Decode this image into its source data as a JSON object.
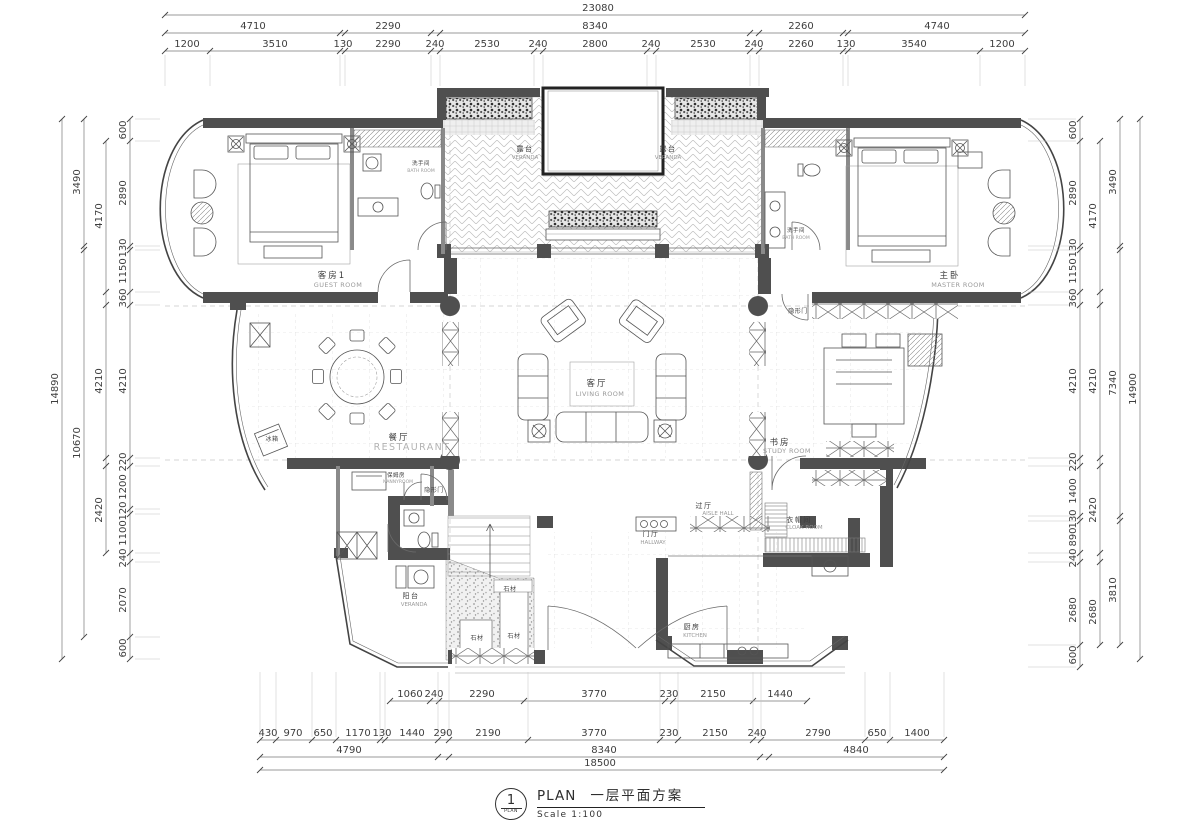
{
  "title": {
    "sheet_no": "1",
    "circle_sub": "PLAN",
    "plan_label": "PLAN",
    "cn_title": "一层平面方案",
    "scale_label": "Scale 1:100"
  },
  "dimensions": [
    {
      "axis": "x",
      "pos": 15,
      "span": [
        165,
        1025
      ],
      "ticks": [
        165,
        1025
      ],
      "labels": [
        {
          "t": "23080",
          "p": 598
        }
      ]
    },
    {
      "axis": "x",
      "pos": 33,
      "span": [
        165,
        1025
      ],
      "ticks": [
        165,
        340,
        345,
        431,
        440,
        750,
        759,
        843,
        848,
        1025
      ],
      "labels": [
        {
          "t": "4710",
          "p": 253
        },
        {
          "t": "2290",
          "p": 388
        },
        {
          "t": "8340",
          "p": 595
        },
        {
          "t": "2260",
          "p": 801
        },
        {
          "t": "4740",
          "p": 937
        }
      ]
    },
    {
      "axis": "x",
      "pos": 51,
      "span": [
        165,
        1025
      ],
      "ticks": [
        165,
        210,
        340,
        345,
        431,
        440,
        534,
        543,
        647,
        656,
        750,
        759,
        843,
        848,
        980,
        1025
      ],
      "ext": [
        55,
        86
      ],
      "labels": [
        {
          "t": "1200",
          "p": 187
        },
        {
          "t": "3510",
          "p": 275
        },
        {
          "t": "130",
          "p": 343
        },
        {
          "t": "2290",
          "p": 388
        },
        {
          "t": "240",
          "p": 435
        },
        {
          "t": "2530",
          "p": 487
        },
        {
          "t": "240",
          "p": 538
        },
        {
          "t": "2800",
          "p": 595
        },
        {
          "t": "240",
          "p": 651
        },
        {
          "t": "2530",
          "p": 703
        },
        {
          "t": "240",
          "p": 754
        },
        {
          "t": "2260",
          "p": 801
        },
        {
          "t": "130",
          "p": 846
        },
        {
          "t": "3540",
          "p": 914
        },
        {
          "t": "1200",
          "p": 1002
        }
      ]
    },
    {
      "axis": "x",
      "pos": 701,
      "span": [
        390,
        807
      ],
      "ticks": [
        390,
        430,
        439,
        524,
        665,
        673,
        753,
        807
      ],
      "labels": [
        {
          "t": "1060",
          "p": 410
        },
        {
          "t": "240",
          "p": 434
        },
        {
          "t": "2290",
          "p": 482
        },
        {
          "t": "3770",
          "p": 594
        },
        {
          "t": "230",
          "p": 669
        },
        {
          "t": "2150",
          "p": 713
        },
        {
          "t": "1440",
          "p": 780
        }
      ]
    },
    {
      "axis": "x",
      "pos": 740,
      "span": [
        260,
        944
      ],
      "ticks": [
        260,
        276,
        312,
        336,
        380,
        385,
        438,
        449,
        528,
        660,
        678,
        753,
        761,
        865,
        890,
        944
      ],
      "ext": [
        672,
        737
      ],
      "labels": [
        {
          "t": "430",
          "p": 268
        },
        {
          "t": "970",
          "p": 293
        },
        {
          "t": "650",
          "p": 323
        },
        {
          "t": "1170",
          "p": 358
        },
        {
          "t": "130",
          "p": 382
        },
        {
          "t": "1440",
          "p": 412
        },
        {
          "t": "290",
          "p": 443
        },
        {
          "t": "2190",
          "p": 488
        },
        {
          "t": "3770",
          "p": 594
        },
        {
          "t": "230",
          "p": 669
        },
        {
          "t": "2150",
          "p": 715
        },
        {
          "t": "240",
          "p": 757
        },
        {
          "t": "2790",
          "p": 818
        },
        {
          "t": "650",
          "p": 877
        },
        {
          "t": "1400",
          "p": 917
        }
      ]
    },
    {
      "axis": "x",
      "pos": 757,
      "span": [
        260,
        944
      ],
      "ticks": [
        260,
        438,
        449,
        760,
        769,
        944
      ],
      "labels": [
        {
          "t": "4790",
          "p": 349
        },
        {
          "t": "8340",
          "p": 604
        },
        {
          "t": "4840",
          "p": 856
        }
      ]
    },
    {
      "axis": "x",
      "pos": 770,
      "span": [
        260,
        944
      ],
      "ticks": [
        260,
        944
      ],
      "labels": [
        {
          "t": "18500",
          "p": 600
        }
      ]
    },
    {
      "axis": "y",
      "pos": 130,
      "span": [
        119,
        659
      ],
      "ticks": [
        119,
        141,
        246,
        250,
        292,
        305,
        458,
        466,
        509,
        514,
        553,
        562,
        637,
        659
      ],
      "ext": [
        135,
        160
      ],
      "labels": [
        {
          "t": "600",
          "p": 130
        },
        {
          "t": "2890",
          "p": 193
        },
        {
          "t": "130",
          "p": 248
        },
        {
          "t": "1150",
          "p": 271
        },
        {
          "t": "360",
          "p": 298
        },
        {
          "t": "4210",
          "p": 381
        },
        {
          "t": "220",
          "p": 462
        },
        {
          "t": "1200",
          "p": 487
        },
        {
          "t": "120",
          "p": 511
        },
        {
          "t": "1100",
          "p": 533
        },
        {
          "t": "240",
          "p": 558
        },
        {
          "t": "2070",
          "p": 600
        },
        {
          "t": "600",
          "p": 648
        }
      ]
    },
    {
      "axis": "y",
      "pos": 106,
      "span": [
        141,
        553
      ],
      "ticks": [
        141,
        292,
        305,
        458,
        466,
        553
      ],
      "labels": [
        {
          "t": "4170",
          "p": 216
        },
        {
          "t": "4210",
          "p": 381
        },
        {
          "t": "2420",
          "p": 510
        }
      ]
    },
    {
      "axis": "y",
      "pos": 84,
      "span": [
        119,
        637
      ],
      "ticks": [
        119,
        246,
        250,
        637
      ],
      "labels": [
        {
          "t": "3490",
          "p": 182
        },
        {
          "t": "10670",
          "p": 443
        }
      ]
    },
    {
      "axis": "y",
      "pos": 62,
      "span": [
        119,
        659
      ],
      "ticks": [
        119,
        659
      ],
      "labels": [
        {
          "t": "14890",
          "p": 389
        }
      ]
    },
    {
      "axis": "y",
      "pos": 1080,
      "span": [
        119,
        667
      ],
      "ticks": [
        119,
        141,
        246,
        250,
        292,
        305,
        458,
        466,
        516,
        521,
        553,
        562,
        645,
        667
      ],
      "ext": [
        1028,
        1076
      ],
      "labels": [
        {
          "t": "600",
          "p": 130
        },
        {
          "t": "2890",
          "p": 193
        },
        {
          "t": "130",
          "p": 248
        },
        {
          "t": "1150",
          "p": 271
        },
        {
          "t": "360",
          "p": 298
        },
        {
          "t": "4210",
          "p": 381
        },
        {
          "t": "220",
          "p": 462
        },
        {
          "t": "1400",
          "p": 491
        },
        {
          "t": "130",
          "p": 519
        },
        {
          "t": "890",
          "p": 537
        },
        {
          "t": "240",
          "p": 558
        },
        {
          "t": "2680",
          "p": 610
        },
        {
          "t": "600",
          "p": 655
        }
      ]
    },
    {
      "axis": "y",
      "pos": 1100,
      "span": [
        141,
        645
      ],
      "ticks": [
        141,
        292,
        305,
        458,
        466,
        553,
        562,
        645
      ],
      "labels": [
        {
          "t": "4170",
          "p": 216
        },
        {
          "t": "4210",
          "p": 381
        },
        {
          "t": "2420",
          "p": 510
        },
        {
          "t": "2680",
          "p": 612
        }
      ]
    },
    {
      "axis": "y",
      "pos": 1120,
      "span": [
        119,
        645
      ],
      "ticks": [
        119,
        246,
        250,
        516,
        521,
        645
      ],
      "labels": [
        {
          "t": "3490",
          "p": 182
        },
        {
          "t": "7340",
          "p": 383
        },
        {
          "t": "3810",
          "p": 590
        }
      ]
    },
    {
      "axis": "y",
      "pos": 1140,
      "span": [
        119,
        659
      ],
      "ticks": [
        119,
        659
      ],
      "labels": [
        {
          "t": "14900",
          "p": 389
        }
      ]
    }
  ],
  "rooms": [
    {
      "cn": "露台",
      "en": "VERANDA",
      "x": 525,
      "y": 151,
      "ex": 525,
      "ey": 159,
      "sz": "sm"
    },
    {
      "cn": "露台",
      "en": "VERANDA",
      "x": 668,
      "y": 151,
      "ex": 668,
      "ey": 159,
      "sz": "sm"
    },
    {
      "cn": "洗手间",
      "en": "BATH ROOM",
      "x": 421,
      "y": 165,
      "ex": 421,
      "ey": 172,
      "sz": "xs"
    },
    {
      "cn": "洗手间",
      "en": "BATH ROOM",
      "x": 796,
      "y": 232,
      "ex": 796,
      "ey": 239,
      "sz": "xs"
    },
    {
      "cn": "客房1",
      "en": "GUEST ROOM",
      "x": 332,
      "y": 278,
      "ex": 338,
      "ey": 287
    },
    {
      "cn": "主卧",
      "en": "MASTER ROOM",
      "x": 950,
      "y": 278,
      "ex": 958,
      "ey": 287
    },
    {
      "cn": "客厅",
      "en": "LIVING ROOM",
      "x": 597,
      "y": 386,
      "ex": 600,
      "ey": 396
    },
    {
      "cn": "餐厅",
      "en": "RESTAURANT",
      "x": 399,
      "y": 440,
      "ex": 412,
      "ey": 450,
      "encls": "en-lg"
    },
    {
      "cn": "书房",
      "en": "STUDY ROOM",
      "x": 780,
      "y": 445,
      "ex": 787,
      "ey": 453
    },
    {
      "cn": "衣帽间",
      "en": "CLOAK ROOM",
      "x": 799,
      "y": 522,
      "ex": 804,
      "ey": 529,
      "sz": "sm"
    },
    {
      "cn": "过厅",
      "en": "AISLE HALL",
      "x": 704,
      "y": 508,
      "ex": 718,
      "ey": 515,
      "sz": "sm"
    },
    {
      "cn": "门厅",
      "en": "HALLWAY",
      "x": 651,
      "y": 536,
      "ex": 653,
      "ey": 544,
      "sz": "sm"
    },
    {
      "cn": "厨房",
      "en": "KITCHEN",
      "x": 692,
      "y": 629,
      "ex": 695,
      "ey": 637,
      "sz": "sm"
    },
    {
      "cn": "阳台",
      "en": "VERANDA",
      "x": 411,
      "y": 598,
      "ex": 414,
      "ey": 606,
      "sz": "sm"
    },
    {
      "cn": "保姆房",
      "en": "NANNYROOM",
      "x": 396,
      "y": 477,
      "ex": 398,
      "ey": 483,
      "sz": "xs"
    }
  ],
  "annotations": [
    {
      "t": "隐形门",
      "x": 434,
      "y": 492
    },
    {
      "t": "隐形门",
      "x": 798,
      "y": 313
    },
    {
      "t": "冰箱",
      "x": 272,
      "y": 441
    },
    {
      "t": "石材",
      "x": 477,
      "y": 640
    },
    {
      "t": "石材",
      "x": 514,
      "y": 638
    },
    {
      "t": "石材",
      "x": 510,
      "y": 591
    }
  ]
}
